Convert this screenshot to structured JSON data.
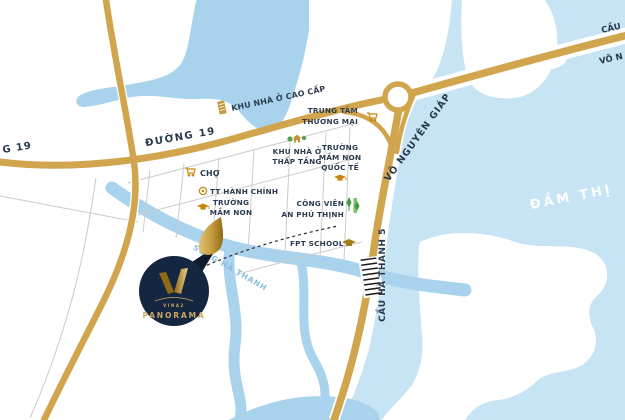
{
  "logo": {
    "brand_small": "VINA2",
    "brand": "PANORAMA"
  },
  "roads": {
    "duong_19": "ĐƯỜNG 19",
    "duong_19_cut": "G 19",
    "vo_nguyen_giap": "VÕ NGUYÊN GIÁP",
    "cau_ha_thanh_5": "CẦU HÀ THANH 5",
    "cau_cut": "CẦU",
    "vo_nguyen_giap_cut": "VÕ N"
  },
  "water": {
    "dam_thi_nai": "ĐẦM THỊ",
    "song_ha_thanh": "SÔNG HÀ THANH"
  },
  "pois": {
    "khu_nha_o_cao_cap": {
      "label": "KHU NHÀ Ở CAO CẤP"
    },
    "trung_tam_thuong_mai": {
      "line1": "TRUNG TÂM",
      "line2": "THƯƠNG MẠI"
    },
    "khu_nha_o_thap_tang": {
      "line1": "KHU NHÀ Ở",
      "line2": "THẤP TẦNG"
    },
    "truong_mam_non_quoc_te": {
      "line1": "TRƯỜNG",
      "line2": "MẦM NON",
      "line3": "QUỐC TẾ"
    },
    "cho": {
      "label": "CHỢ"
    },
    "tt_hanh_chinh": {
      "label": "TT HÀNH CHÍNH"
    },
    "truong_mam_non": {
      "line1": "TRƯỜNG",
      "line2": "MẦM NON"
    },
    "cong_vien_an_phu_thinh": {
      "line1": "CÔNG VIÊN",
      "line2": "AN PHÚ THỊNH"
    },
    "fpt_school": {
      "label": "FPT SCHOOL"
    }
  },
  "colors": {
    "road_gold": "#D1A54D",
    "icon_gold": "#C8860D",
    "label_navy": "#2B3C50",
    "water_lagoon": "#C7E4F4",
    "water_river": "#A9D3EC",
    "logo_navy": "#152740",
    "logo_gold": "#C9A765",
    "park_green": "#4CAF50",
    "street_gray": "#CBCBCB"
  }
}
